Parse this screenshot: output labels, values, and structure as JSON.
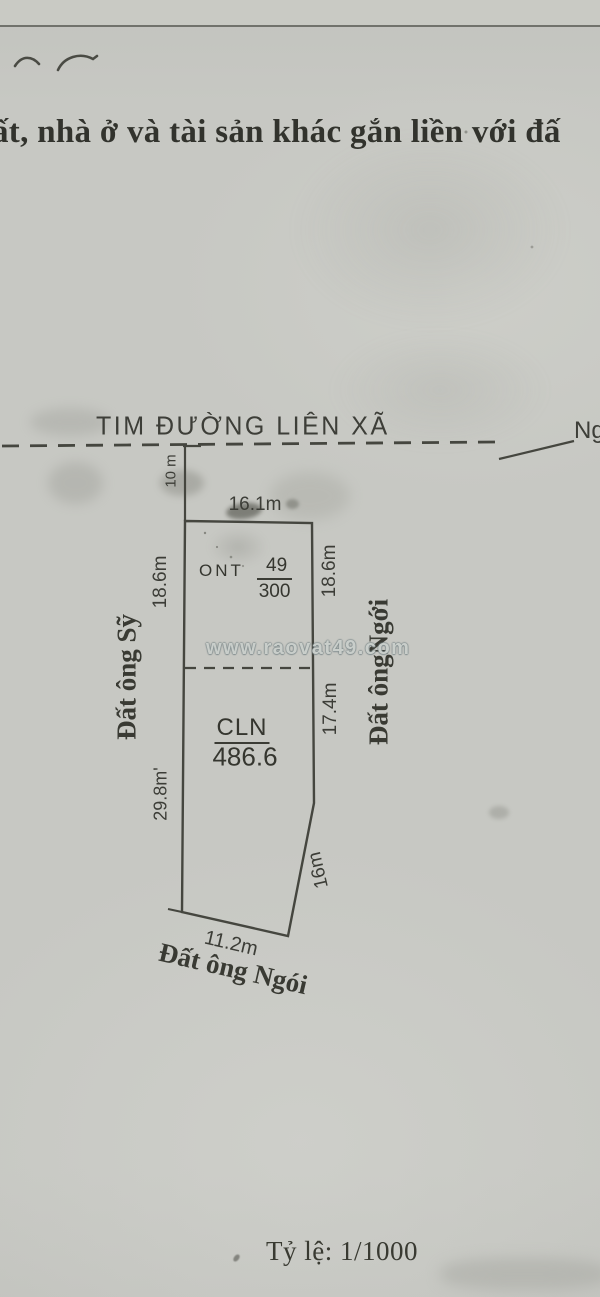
{
  "header": {
    "title_fragment": "ất, nhà ở và tài sản khác gắn liền với đấ"
  },
  "road": {
    "label": "TIM  ĐƯỜNG LIÊN XÃ",
    "right_label_fragment": "Ng"
  },
  "parcel": {
    "setback_dim": "10 m",
    "dims": {
      "top": "16.1m",
      "left_upper": "18.6m",
      "right_upper": "18.6m",
      "right_middle": "17.4m",
      "left_lower": "29.8m'",
      "right_lower": "16m",
      "bottom": "11.2m"
    },
    "zones": {
      "ont_label": "ONT",
      "ont_numerator": "49",
      "ont_denominator": "300",
      "cln_label": "CLN",
      "cln_area": "486.6"
    },
    "neighbors": {
      "left": "Đất ông Sỹ",
      "right": "Đất ôngNgới",
      "bottom": "Đất ông Ngói"
    }
  },
  "watermark": {
    "text": "www.raovat49.com"
  },
  "footer": {
    "scale_label": "Tỷ lệ: 1/1000"
  },
  "colors": {
    "paper": "#c7c8c3",
    "ink": "#3b3c35",
    "watermark_outline": "#788587"
  }
}
